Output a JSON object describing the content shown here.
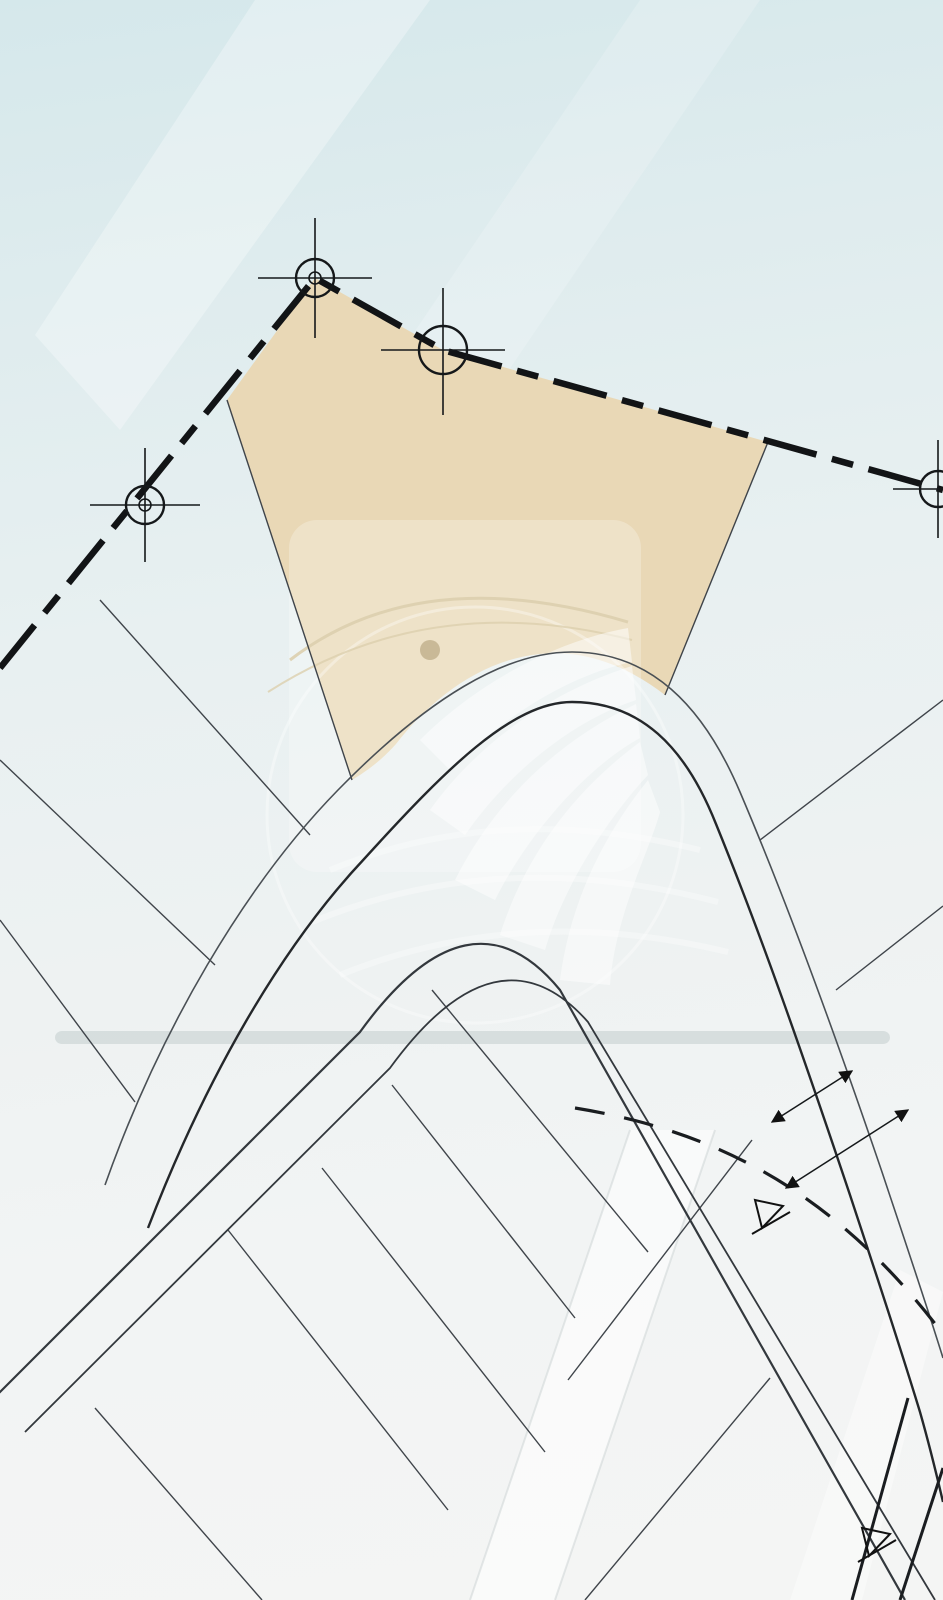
{
  "watermark": {
    "brand": "REALTY WORLD",
    "registered": "®",
    "tagline": "BIENES RAICES"
  },
  "highlight_lot": {
    "area": "A=887.10m2",
    "name": "L-07"
  },
  "label_defaults": {
    "size": 16,
    "color": "#43484e",
    "weight": 400
  },
  "labels": [
    {
      "t": "A=887.10m2",
      "x": 456,
      "y": 500,
      "r": 0,
      "s": 34,
      "c": "#17191c",
      "w": 500,
      "n": "lot-area-label"
    },
    {
      "t": "L-07",
      "x": 441,
      "y": 549,
      "r": 0,
      "s": 34,
      "c": "#9aa1a7",
      "w": 400,
      "ls": 6,
      "n": "lot-id-label"
    },
    {
      "t": "10.875",
      "x": 392,
      "y": 303,
      "r": 25,
      "s": 30,
      "c": "#1d2124",
      "w": 600,
      "n": "boundary-dim-label"
    },
    {
      "t": "21.222",
      "x": 224,
      "y": 352,
      "r": -52,
      "s": 30,
      "c": "#1d2124",
      "w": 600,
      "n": "boundary-dim-label"
    },
    {
      "t": "38.531",
      "x": 700,
      "y": 394,
      "r": 12,
      "s": 30,
      "c": "#1d2124",
      "w": 600,
      "n": "boundary-dim-label"
    },
    {
      "t": "12.04",
      "x": 60,
      "y": 640,
      "r": -52,
      "s": 24,
      "c": "#1d2124",
      "w": 600,
      "n": "boundary-dim-label"
    },
    {
      "t": "8.00",
      "x": 800,
      "y": 1080,
      "r": -28,
      "s": 24,
      "c": "#1d2124",
      "w": 600,
      "n": "road-width-label"
    },
    {
      "t": "13.00",
      "x": 838,
      "y": 1156,
      "r": -28,
      "s": 24,
      "c": "#1d2124",
      "w": 600,
      "n": "road-width-label"
    },
    {
      "t": "10.875m",
      "x": 390,
      "y": 343,
      "r": 25,
      "n": "dimension-label"
    },
    {
      "t": "14.050m",
      "x": 258,
      "y": 382,
      "r": -52,
      "n": "dimension-label"
    },
    {
      "t": "27.589m",
      "x": 625,
      "y": 412,
      "r": 12,
      "n": "dimension-label"
    },
    {
      "t": "10.942m",
      "x": 877,
      "y": 477,
      "r": 12,
      "n": "dimension-label"
    },
    {
      "t": "28.723m",
      "x": 287,
      "y": 601,
      "r": -71,
      "n": "dimension-label"
    },
    {
      "t": "22.818m",
      "x": 752,
      "y": 594,
      "r": -65,
      "n": "dimension-label"
    },
    {
      "t": "28.86",
      "x": 201,
      "y": 731,
      "r": -50,
      "n": "dimension-label"
    },
    {
      "t": "28.89",
      "x": 104,
      "y": 865,
      "r": -50,
      "n": "dimension-label"
    },
    {
      "t": "28.92",
      "x": 15,
      "y": 989,
      "r": -50,
      "n": "dimension-label"
    },
    {
      "t": "12.06",
      "x": 234,
      "y": 951,
      "r": 42,
      "n": "dimension-label"
    },
    {
      "t": "12.06",
      "x": 132,
      "y": 1089,
      "r": 42,
      "n": "dimension-label"
    },
    {
      "t": "12.06",
      "x": 28,
      "y": 1166,
      "r": 42,
      "n": "dimension-label"
    },
    {
      "t": "26.944m",
      "x": 903,
      "y": 757,
      "r": -35,
      "n": "dimension-label"
    },
    {
      "t": "14.130m",
      "x": 812,
      "y": 922,
      "r": -57,
      "n": "dimension-label"
    },
    {
      "t": "13.680m",
      "x": 910,
      "y": 1082,
      "r": -57,
      "n": "dimension-label"
    },
    {
      "t": "16.550m",
      "x": 664,
      "y": 1025,
      "r": -70,
      "n": "dimension-label"
    },
    {
      "t": "6.490m",
      "x": 560,
      "y": 940,
      "r": 12,
      "n": "dimension-label"
    },
    {
      "t": "4.892m",
      "x": 484,
      "y": 972,
      "r": -55,
      "n": "dimension-label"
    },
    {
      "t": "13.490m",
      "x": 413,
      "y": 953,
      "r": -45,
      "n": "dimension-label"
    },
    {
      "t": "13.490m",
      "x": 350,
      "y": 1069,
      "r": -45,
      "n": "dimension-label"
    },
    {
      "t": "13.490m",
      "x": 288,
      "y": 1187,
      "r": -45,
      "n": "dimension-label"
    },
    {
      "t": "13.490m",
      "x": 163,
      "y": 1343,
      "r": -45,
      "n": "dimension-label"
    },
    {
      "t": "13.398m",
      "x": 26,
      "y": 1513,
      "r": -45,
      "n": "dimension-label"
    },
    {
      "t": "0.092m",
      "x": 76,
      "y": 1458,
      "r": -45,
      "n": "dimension-label"
    },
    {
      "t": "27.737m",
      "x": 526,
      "y": 1123,
      "r": -50,
      "n": "dimension-label"
    },
    {
      "t": "27.737m",
      "x": 420,
      "y": 1270,
      "r": -50,
      "n": "dimension-label"
    },
    {
      "t": "27.737m",
      "x": 305,
      "y": 1418,
      "r": -50,
      "n": "dimension-label"
    },
    {
      "t": "27.737m",
      "x": 191,
      "y": 1558,
      "r": -50,
      "n": "dimension-label"
    },
    {
      "t": "13.490m",
      "x": 558,
      "y": 1378,
      "r": -45,
      "n": "dimension-label"
    },
    {
      "t": "12.110m",
      "x": 519,
      "y": 1445,
      "r": -45,
      "n": "dimension-label"
    },
    {
      "t": "13.490m",
      "x": 443,
      "y": 1516,
      "r": -45,
      "n": "dimension-label"
    },
    {
      "t": "12.110m",
      "x": 405,
      "y": 1572,
      "r": -45,
      "n": "dimension-label"
    },
    {
      "t": "30.645m",
      "x": 628,
      "y": 1533,
      "r": 52,
      "n": "dimension-label"
    },
    {
      "t": "22.414m",
      "x": 648,
      "y": 1262,
      "r": -38,
      "n": "dimension-label"
    },
    {
      "t": "15.705m",
      "x": 690,
      "y": 1198,
      "r": -38,
      "n": "dimension-label"
    },
    {
      "t": "27.868m",
      "x": 845,
      "y": 1303,
      "r": -57,
      "n": "dimension-label"
    },
    {
      "t": "2m",
      "x": 858,
      "y": 1596,
      "r": -55,
      "n": "dimension-label"
    },
    {
      "t": "Lc=12.201m",
      "x": 602,
      "y": 668,
      "r": 13,
      "s": 15,
      "c": "#4e545a",
      "n": "arc-length-label"
    },
    {
      "t": "Lc=11.279m",
      "x": 457,
      "y": 714,
      "r": -28,
      "s": 14,
      "c": "#4e545a",
      "n": "arc-length-label"
    },
    {
      "t": "Lc=0.902m",
      "x": 383,
      "y": 754,
      "r": -52,
      "s": 14,
      "c": "#4e545a",
      "n": "arc-length-label"
    },
    {
      "t": "Lc=5.450m",
      "x": 352,
      "y": 795,
      "r": -52,
      "s": 14,
      "c": "#4e545a",
      "n": "arc-length-label"
    },
    {
      "t": "A=7.404m",
      "x": 311,
      "y": 858,
      "r": -52,
      "s": 13,
      "c": "#4e545a",
      "n": "arc-length-label"
    },
    {
      "t": "Lc=4.697m",
      "x": 701,
      "y": 748,
      "r": 62,
      "s": 13,
      "c": "#4e545a",
      "n": "arc-length-label"
    },
    {
      "t": "Lc=6.336m",
      "x": 737,
      "y": 812,
      "r": 62,
      "s": 13,
      "c": "#4e545a",
      "n": "arc-length-label"
    },
    {
      "t": "Lc=3.728m",
      "x": 920,
      "y": 1477,
      "r": -70,
      "s": 16,
      "c": "#3a3f44",
      "n": "arc-length-label"
    },
    {
      "t": "L-06",
      "x": 263,
      "y": 782,
      "r": 42,
      "s": 28,
      "c": "#81878d",
      "ls": 2,
      "n": "lot-id-label"
    },
    {
      "t": "L-05",
      "x": 190,
      "y": 936,
      "r": 42,
      "s": 28,
      "c": "#81878d",
      "ls": 2,
      "n": "lot-id-label"
    },
    {
      "t": "L-04",
      "x": 88,
      "y": 1073,
      "r": 42,
      "s": 28,
      "c": "#81878d",
      "ls": 2,
      "n": "lot-id-label"
    },
    {
      "t": "L-08",
      "x": 720,
      "y": 686,
      "r": -35,
      "s": 28,
      "c": "#6f757b",
      "ls": 2,
      "n": "lot-id-label"
    },
    {
      "t": "L-09",
      "x": 826,
      "y": 848,
      "r": -35,
      "s": 28,
      "c": "#6f757b",
      "ls": 2,
      "n": "lot-id-label"
    },
    {
      "t": "L-10",
      "x": 924,
      "y": 1016,
      "r": -35,
      "s": 28,
      "c": "#6f757b",
      "ls": 2,
      "n": "lot-id-label"
    },
    {
      "t": "L-06",
      "x": 529,
      "y": 958,
      "r": 48,
      "s": 28,
      "c": "#50555b",
      "ls": 2,
      "n": "lot-id-label"
    },
    {
      "t": "L-05",
      "x": 448,
      "y": 1041,
      "r": 48,
      "s": 28,
      "c": "#50555b",
      "ls": 2,
      "n": "lot-id-label"
    },
    {
      "t": "L-04",
      "x": 337,
      "y": 1185,
      "r": 48,
      "s": 28,
      "c": "#50555b",
      "ls": 2,
      "n": "lot-id-label"
    },
    {
      "t": "L-03",
      "x": 231,
      "y": 1341,
      "r": 48,
      "s": 28,
      "c": "#50555b",
      "ls": 2,
      "n": "lot-id-label"
    },
    {
      "t": "L-02",
      "x": 114,
      "y": 1489,
      "r": 48,
      "s": 28,
      "c": "#50555b",
      "ls": 2,
      "n": "lot-id-label"
    },
    {
      "t": "L-07",
      "x": 884,
      "y": 1396,
      "r": -52,
      "s": 28,
      "c": "#50555b",
      "ls": 2,
      "n": "lot-id-label"
    },
    {
      "t": "A=344.411m2",
      "x": 233,
      "y": 653,
      "r": -52,
      "s": 27,
      "c": "#51575d",
      "n": "lot-area-label"
    },
    {
      "t": "322.80m2",
      "x": 141,
      "y": 809,
      "r": -52,
      "s": 27,
      "c": "#43484e",
      "n": "lot-area-label"
    },
    {
      "t": "323.21m2",
      "x": 48,
      "y": 941,
      "r": -52,
      "s": 27,
      "c": "#43484e",
      "n": "lot-area-label"
    },
    {
      "t": "A=451.015m2",
      "x": 828,
      "y": 654,
      "r": -35,
      "s": 27,
      "c": "#43484e",
      "n": "lot-area-label"
    },
    {
      "t": "A=378",
      "x": 934,
      "y": 857,
      "r": -35,
      "s": 27,
      "c": "#43484e",
      "n": "lot-area-label"
    },
    {
      "t": "345.132m2",
      "x": 575,
      "y": 1062,
      "r": -50,
      "s": 27,
      "c": "#2a2e33",
      "n": "lot-area-label"
    },
    {
      "t": "345.132m2",
      "x": 451,
      "y": 1246,
      "r": -50,
      "s": 27,
      "c": "#2a2e33",
      "n": "lot-area-label"
    },
    {
      "t": "345.132m2",
      "x": 345,
      "y": 1350,
      "r": -50,
      "s": 27,
      "c": "#2a2e33",
      "n": "lot-area-label"
    },
    {
      "t": "345.132m2",
      "x": 246,
      "y": 1533,
      "r": -50,
      "s": 27,
      "c": "#2a2e33",
      "n": "lot-area-label"
    },
    {
      "t": "345.1",
      "x": 100,
      "y": 1575,
      "r": -50,
      "s": 27,
      "c": "#2a2e33",
      "n": "lot-area-label"
    },
    {
      "t": "661.727m2",
      "x": 753,
      "y": 1420,
      "r": -50,
      "s": 29,
      "c": "#2a2e33",
      "n": "lot-area-label"
    },
    {
      "t": "344.1",
      "x": 585,
      "y": 1583,
      "r": -50,
      "s": 29,
      "c": "#2a2e33",
      "n": "lot-area-label"
    },
    {
      "t": "A",
      "x": 779,
      "y": 1246,
      "r": -62,
      "s": 24,
      "c": "#0e0f10",
      "w": 600,
      "n": "section-marker-label"
    },
    {
      "t": "A",
      "x": 886,
      "y": 1572,
      "r": -62,
      "s": 24,
      "c": "#0e0f10",
      "w": 600,
      "n": "section-marker-label"
    }
  ]
}
